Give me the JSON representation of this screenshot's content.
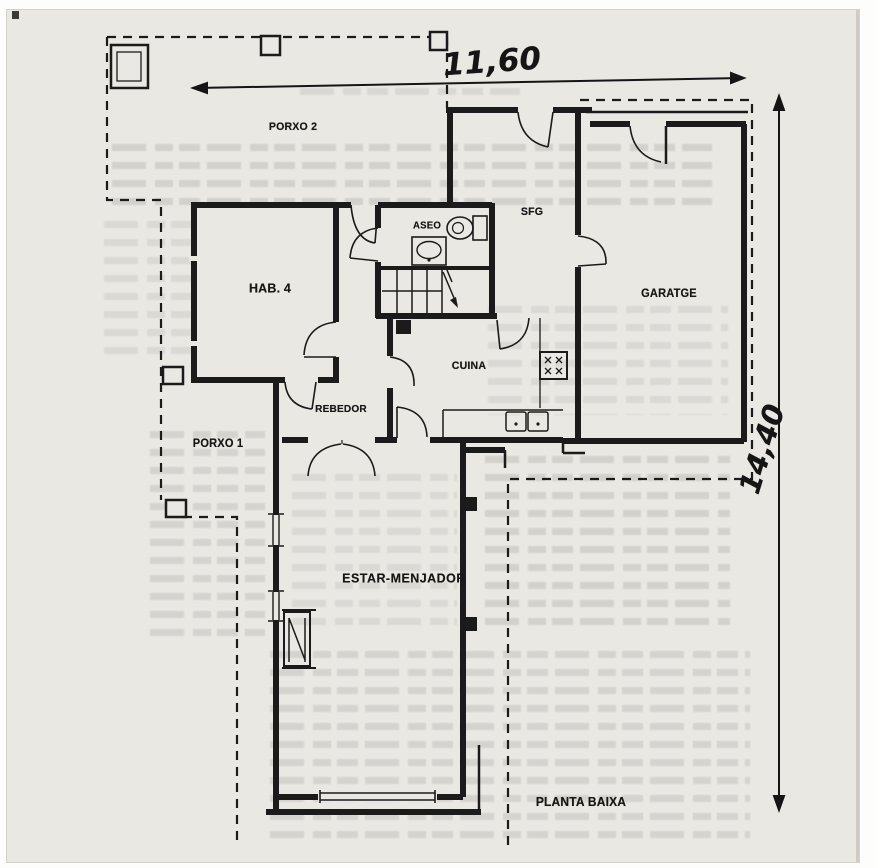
{
  "document": {
    "type": "scanned architectural floor plan",
    "caption": "PLANTA BAIXA"
  },
  "dimensions": {
    "width_label": "11,60",
    "height_label": "14,40"
  },
  "rooms": [
    {
      "id": "porxo-2",
      "label": "PORXO 2"
    },
    {
      "id": "hab-4",
      "label": "HAB. 4"
    },
    {
      "id": "aseo",
      "label": "ASEO"
    },
    {
      "id": "sfg",
      "label": "SFG"
    },
    {
      "id": "garatge",
      "label": "GARATGE"
    },
    {
      "id": "cuina",
      "label": "CUINA"
    },
    {
      "id": "rebedor",
      "label": "REBEDOR"
    },
    {
      "id": "porxo-1",
      "label": "PORXO 1"
    },
    {
      "id": "estar-menjador",
      "label": "ESTAR-MENJADOR"
    }
  ],
  "fixtures": [
    "toilet-icon",
    "washbasin-icon",
    "stove-icon",
    "kitchen-sink-icon",
    "fireplace-icon",
    "staircase-icon"
  ],
  "colors": {
    "paper": "#eae8e3",
    "ink": "#1b1b1b",
    "bleed_text": "#8a887f"
  }
}
